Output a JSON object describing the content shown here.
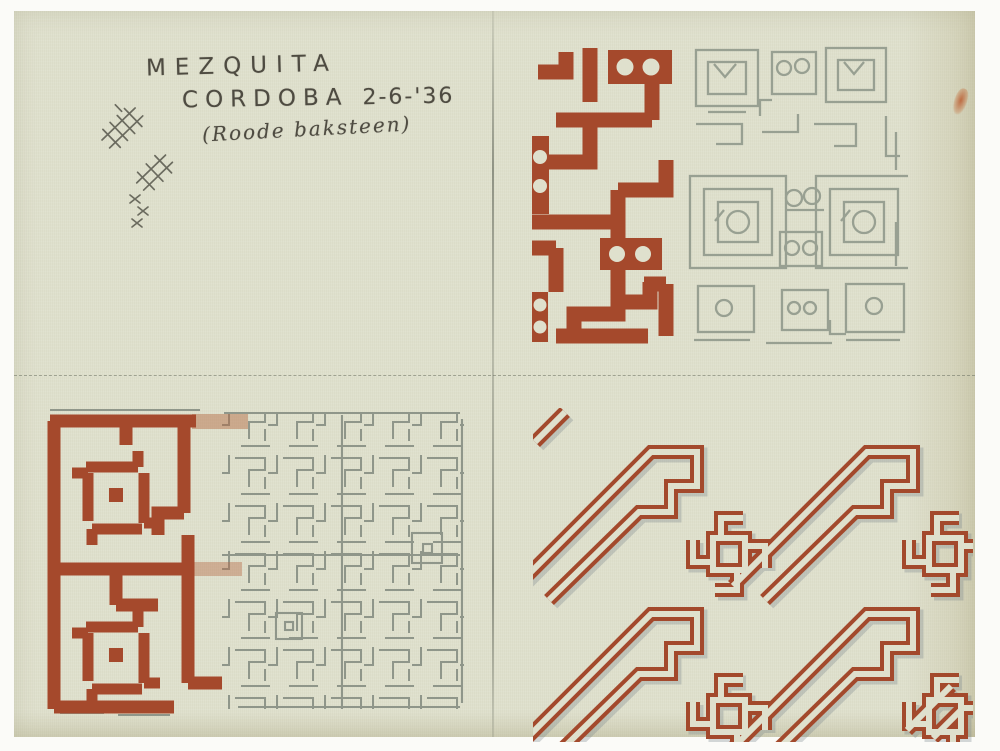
{
  "page": {
    "inscription": {
      "title": "MEZQUITA",
      "location": "CORDOBA",
      "date": "2-6-'36",
      "note": "(Roode baksteen)"
    },
    "colors": {
      "paper": "#dfe0cd",
      "red_pencil": "#a5492c",
      "graphite_pencil": "#8f968a",
      "handwriting": "#4e4b41"
    },
    "quadrants": {
      "top_left": "handwritten inscription with small tally doodles",
      "top_right": "brick meander pattern with round dots, left part coloured red, right part pencil outline",
      "bottom_left": "dense key-fret maze pattern, left border coloured red with knot rosettes",
      "bottom_right": "diagonal pinwheel interlace pattern drawn as hollow red bands"
    }
  }
}
